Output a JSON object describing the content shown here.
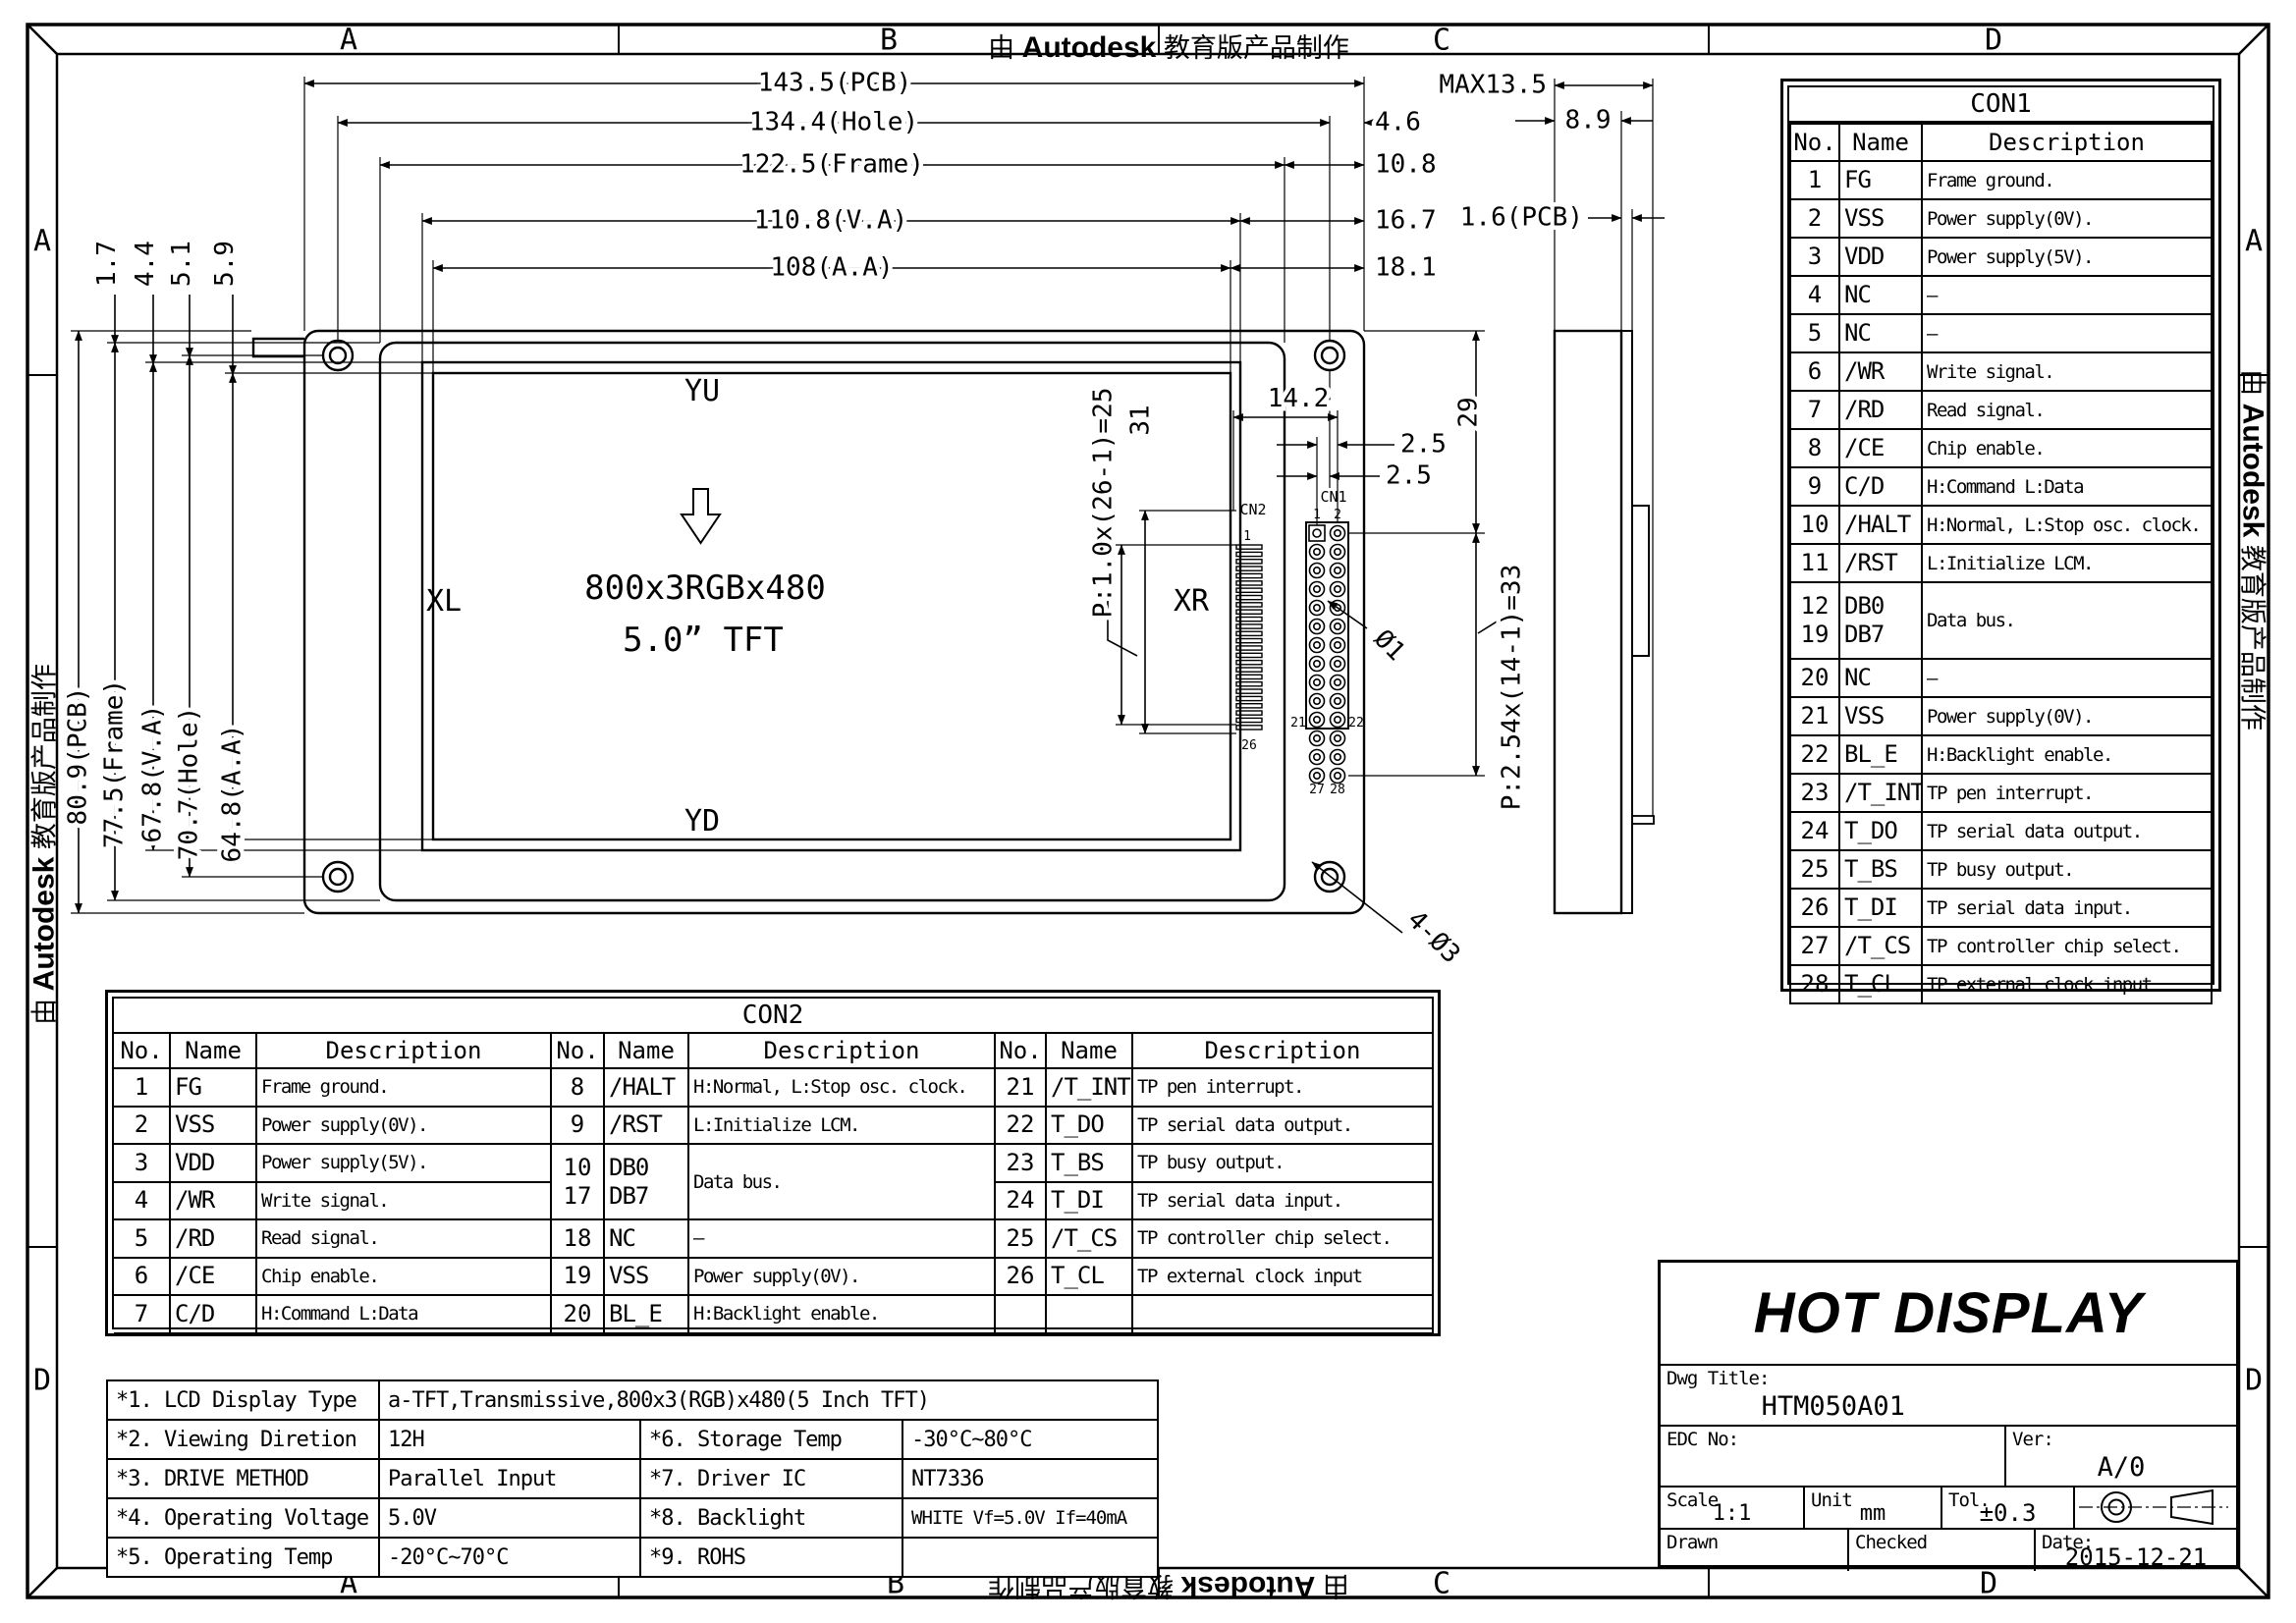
{
  "border": {
    "zones_top": [
      "A",
      "B",
      "C",
      "D"
    ],
    "zones_bottom": [
      "A",
      "B",
      "C",
      "D"
    ],
    "zones_left": [
      "A",
      "D"
    ],
    "zones_right": [
      "A",
      "D"
    ],
    "watermark_prefix": "由",
    "watermark_brand": "Autodesk",
    "watermark_suffix": "教育版产品制作"
  },
  "drawing": {
    "top_dims": [
      "143.5(PCB)",
      "134.4(Hole)",
      "122.5(Frame)",
      "110.8(V.A)",
      "108(A.A)"
    ],
    "right_dims": {
      "d46": "4.6",
      "d108": "10.8",
      "d167": "16.7",
      "d181": "18.1"
    },
    "side_dims": {
      "max": "MAX13.5",
      "d89": "8.9",
      "pcb16": "1.6(PCB)"
    },
    "left_dims": [
      "80.9(PCB)",
      "77.5(Frame)",
      "67.8(V.A)",
      "70.7(Hole)",
      "64.8(A.A)"
    ],
    "left_small_dims": [
      "1.7",
      "4.4",
      "5.1",
      "5.9"
    ],
    "labels": {
      "yu": "YU",
      "xl": "XL",
      "xr": "XR",
      "yd": "YD",
      "resolution": "800x3RGBx480",
      "size": "5.0” TFT"
    },
    "cn_dims": {
      "p1": "P:1.0x(26-1)=25",
      "d31": "31",
      "d142": "14.2",
      "d25a": "2.5",
      "d25b": "2.5",
      "d29": "29",
      "p254": "P:2.54x(14-1)=33",
      "dia1": "Ø1",
      "holes": "4-Ø3"
    },
    "cn1": {
      "label": "CN1",
      "pin_count": 28,
      "pin1": "1",
      "pin2": "2",
      "pin21": "21",
      "pin22": "22",
      "pin27": "27",
      "pin28": "28"
    },
    "cn2": {
      "label": "CN2",
      "pin_count": 26,
      "pin_first": "1",
      "pin_last": "26"
    }
  },
  "con1": {
    "title": "CON1",
    "headers": [
      "No.",
      "Name",
      "Description"
    ],
    "rows": [
      [
        "1",
        "FG",
        "Frame ground."
      ],
      [
        "2",
        "VSS",
        "Power supply(0V)."
      ],
      [
        "3",
        "VDD",
        "Power supply(5V)."
      ],
      [
        "4",
        "NC",
        "—"
      ],
      [
        "5",
        "NC",
        "—"
      ],
      [
        "6",
        "/WR",
        "Write signal."
      ],
      [
        "7",
        "/RD",
        "Read signal."
      ],
      [
        "8",
        "/CE",
        "Chip enable."
      ],
      [
        "9",
        "C/D",
        "H:Command L:Data"
      ],
      [
        "10",
        "/HALT",
        "H:Normal, L:Stop osc. clock."
      ],
      [
        "11",
        "/RST",
        "L:Initialize LCM."
      ],
      [
        "12\n19",
        "DB0\nDB7",
        "Data bus."
      ],
      [
        "20",
        "NC",
        "—"
      ],
      [
        "21",
        "VSS",
        "Power supply(0V)."
      ],
      [
        "22",
        "BL_E",
        "H:Backlight enable."
      ],
      [
        "23",
        "/T_INT",
        "TP pen interrupt."
      ],
      [
        "24",
        "T_DO",
        "TP serial data output."
      ],
      [
        "25",
        "T_BS",
        "TP busy output."
      ],
      [
        "26",
        "T_DI",
        "TP serial data input."
      ],
      [
        "27",
        "/T_CS",
        "TP controller chip select."
      ],
      [
        "28",
        "T_CL",
        "TP external clock input"
      ]
    ]
  },
  "con2": {
    "title": "CON2",
    "headers": [
      "No.",
      "Name",
      "Description"
    ],
    "groups": [
      [
        [
          "1",
          "FG",
          "Frame ground."
        ],
        [
          "2",
          "VSS",
          "Power supply(0V)."
        ],
        [
          "3",
          "VDD",
          "Power supply(5V)."
        ],
        [
          "4",
          "/WR",
          "Write signal."
        ],
        [
          "5",
          "/RD",
          "Read signal."
        ],
        [
          "6",
          "/CE",
          "Chip enable."
        ],
        [
          "7",
          "C/D",
          "H:Command L:Data"
        ]
      ],
      [
        [
          "8",
          "/HALT",
          "H:Normal, L:Stop osc. clock."
        ],
        [
          "9",
          "/RST",
          "L:Initialize LCM."
        ],
        [
          "10\n17",
          "DB0\nDB7",
          "Data bus.",
          2
        ],
        [
          "18",
          "NC",
          "—"
        ],
        [
          "19",
          "VSS",
          "Power supply(0V)."
        ],
        [
          "20",
          "BL_E",
          "H:Backlight enable."
        ]
      ],
      [
        [
          "21",
          "/T_INT",
          "TP pen interrupt."
        ],
        [
          "22",
          "T_DO",
          "TP serial data output."
        ],
        [
          "23",
          "T_BS",
          "TP busy output."
        ],
        [
          "24",
          "T_DI",
          "TP serial data input."
        ],
        [
          "25",
          "/T_CS",
          "TP controller chip select."
        ],
        [
          "26",
          "T_CL",
          "TP external clock input"
        ],
        [
          "",
          "",
          ""
        ]
      ]
    ]
  },
  "notes": {
    "rows": [
      [
        {
          "t": "*1. LCD Display Type"
        },
        {
          "t": "a-TFT,Transmissive,800x3(RGB)x480(5 Inch TFT)",
          "span": 3
        }
      ],
      [
        {
          "t": "*2. Viewing Diretion"
        },
        {
          "t": "12H"
        },
        {
          "t": "*6. Storage Temp"
        },
        {
          "t": "-30°C~80°C"
        }
      ],
      [
        {
          "t": "*3. DRIVE METHOD"
        },
        {
          "t": "Parallel Input"
        },
        {
          "t": "*7. Driver IC"
        },
        {
          "t": "NT7336"
        }
      ],
      [
        {
          "t": "*4. Operating Voltage"
        },
        {
          "t": "5.0V"
        },
        {
          "t": "*8. Backlight"
        },
        {
          "t": "WHITE Vf=5.0V If=40mA",
          "small": true
        }
      ],
      [
        {
          "t": "*5. Operating Temp"
        },
        {
          "t": "-20°C~70°C"
        },
        {
          "t": "*9. ROHS"
        },
        {
          "t": ""
        }
      ]
    ]
  },
  "title_block": {
    "company": "HOT DISPLAY",
    "dwg_title_label": "Dwg Title:",
    "dwg_title": "HTM050A01",
    "edc_label": "EDC No:",
    "ver_label": "Ver:",
    "ver": "A/0",
    "scale_label": "Scale",
    "scale": "1:1",
    "unit_label": "Unit",
    "unit": "mm",
    "tol_label": "Tol.",
    "tol": "±0.3",
    "drawn_label": "Drawn",
    "checked_label": "Checked",
    "date_label": "Date:",
    "date": "2015-12-21"
  }
}
